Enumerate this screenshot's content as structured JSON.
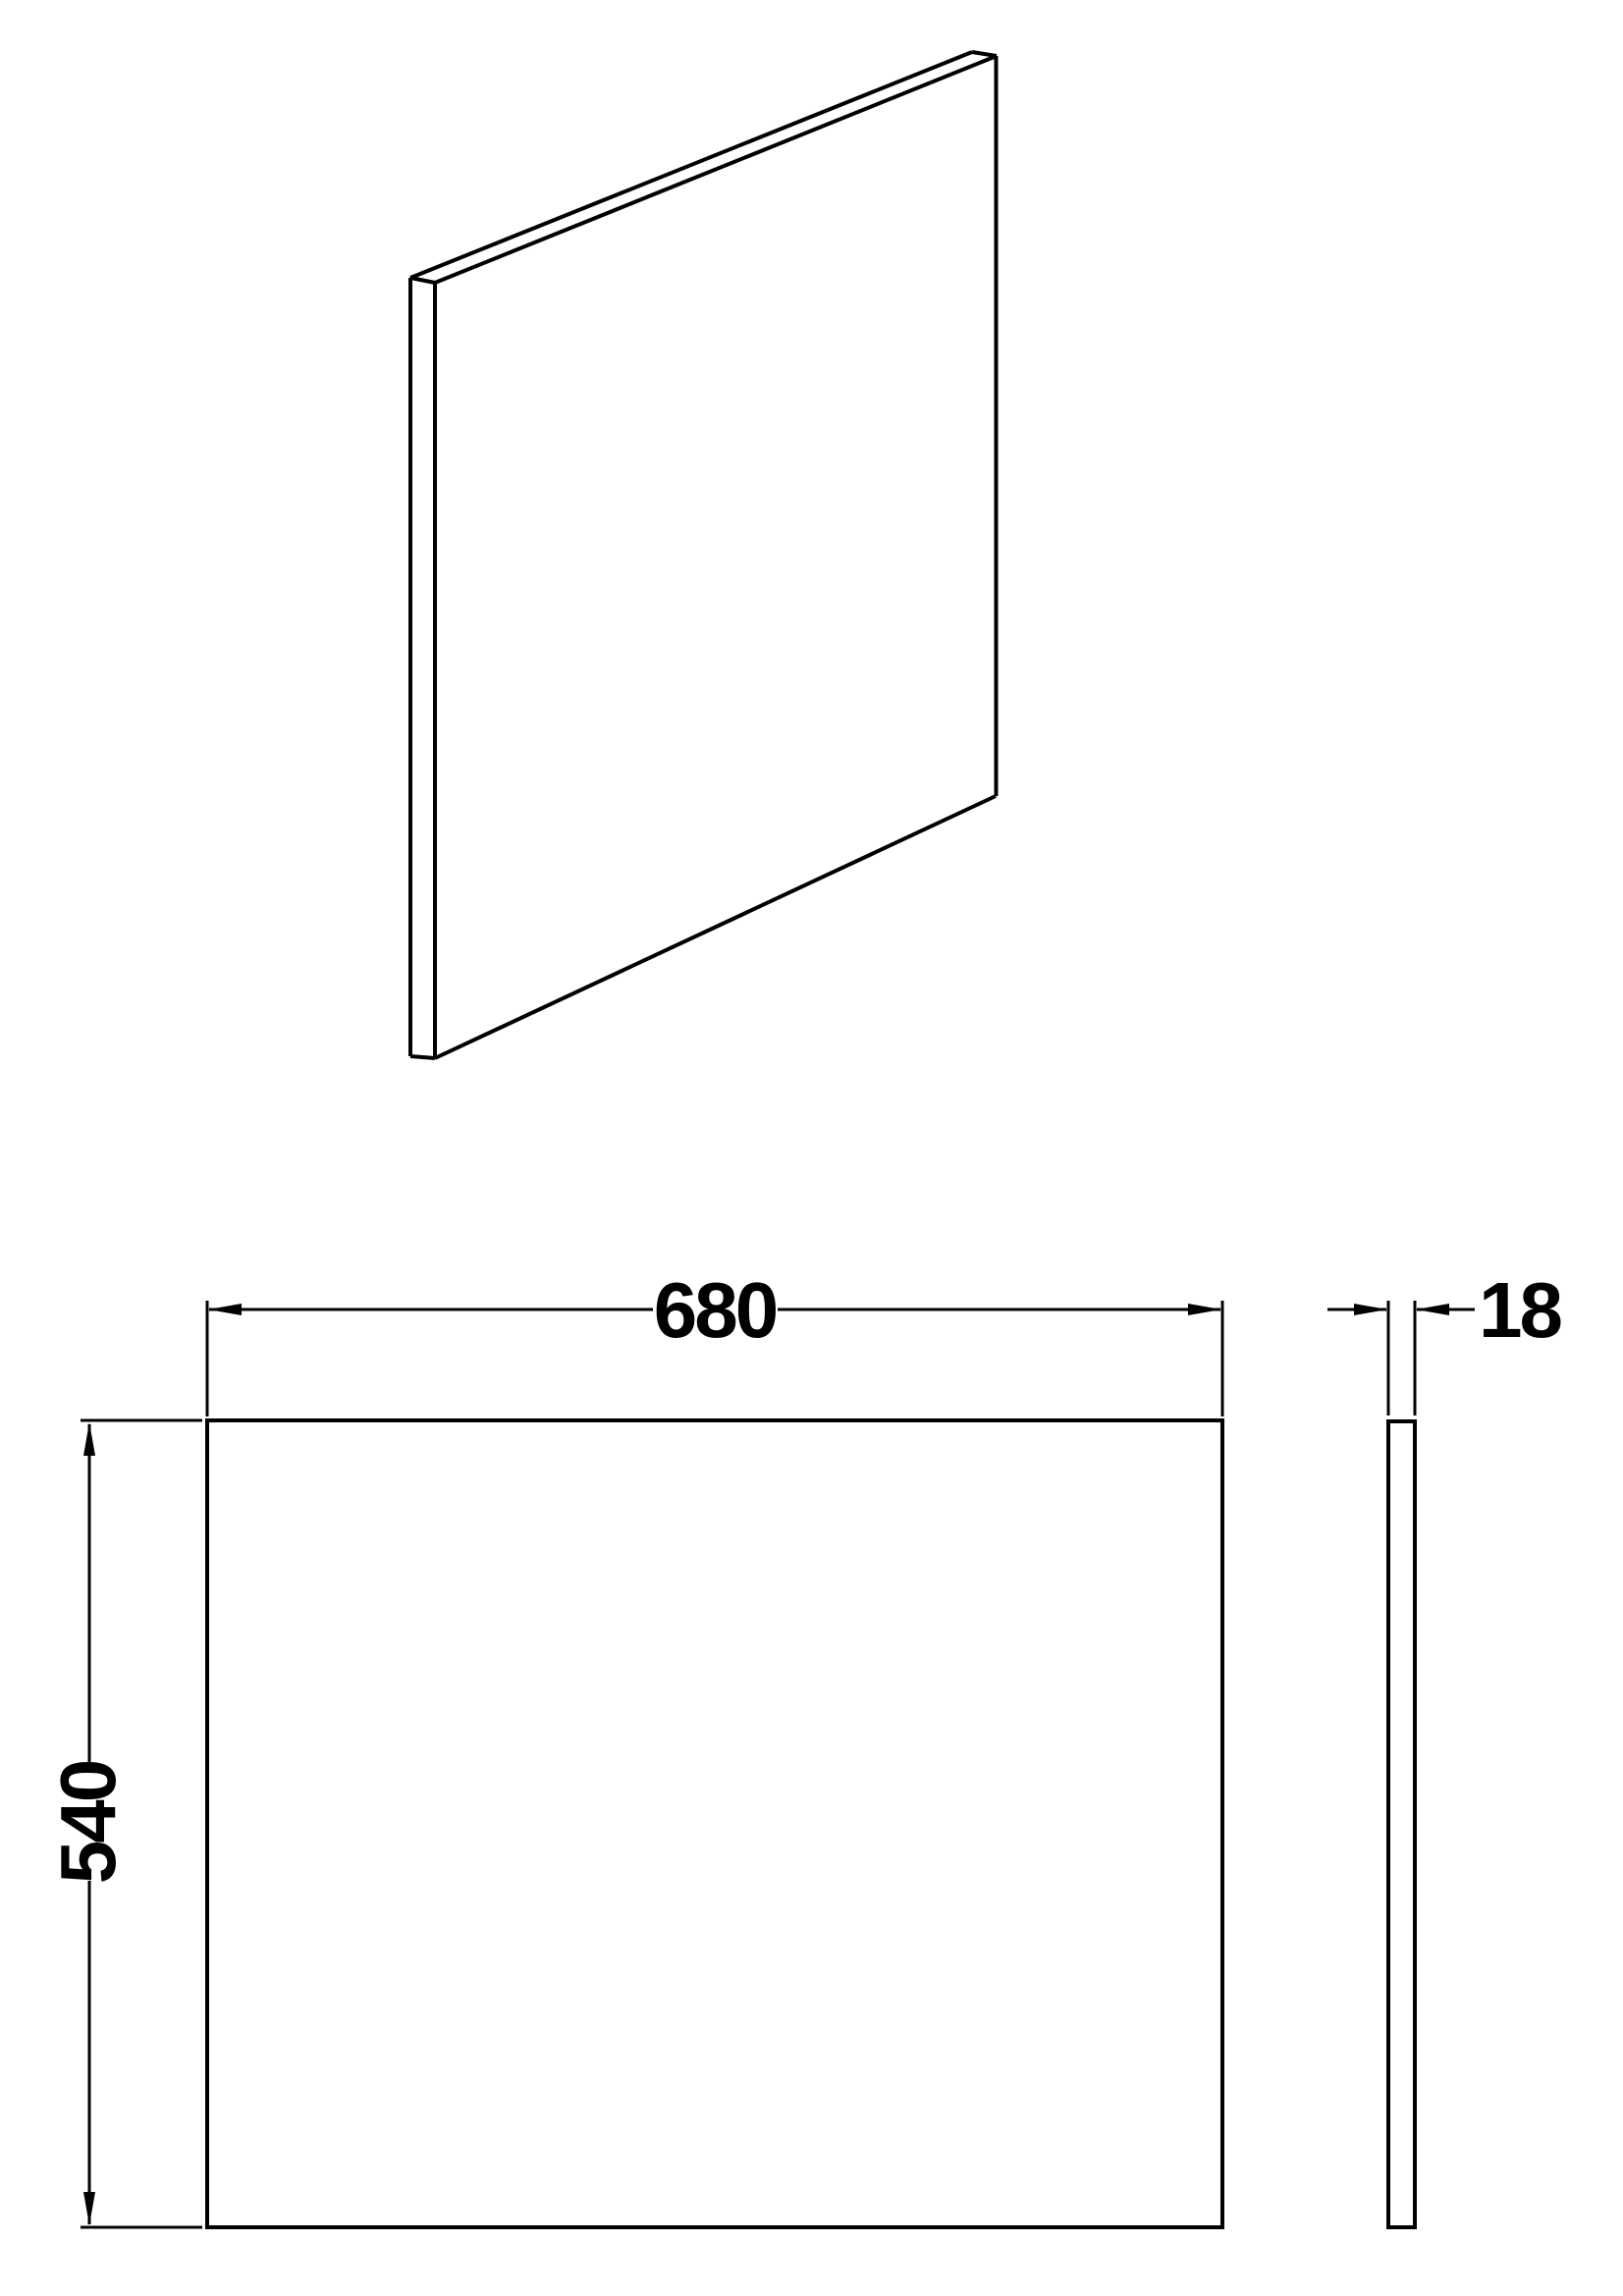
{
  "canvas": {
    "background": "#ffffff",
    "line_color": "#000000"
  },
  "dimensions": {
    "width": {
      "label": "680"
    },
    "height": {
      "label": "540"
    },
    "thickness": {
      "label": "18"
    }
  }
}
